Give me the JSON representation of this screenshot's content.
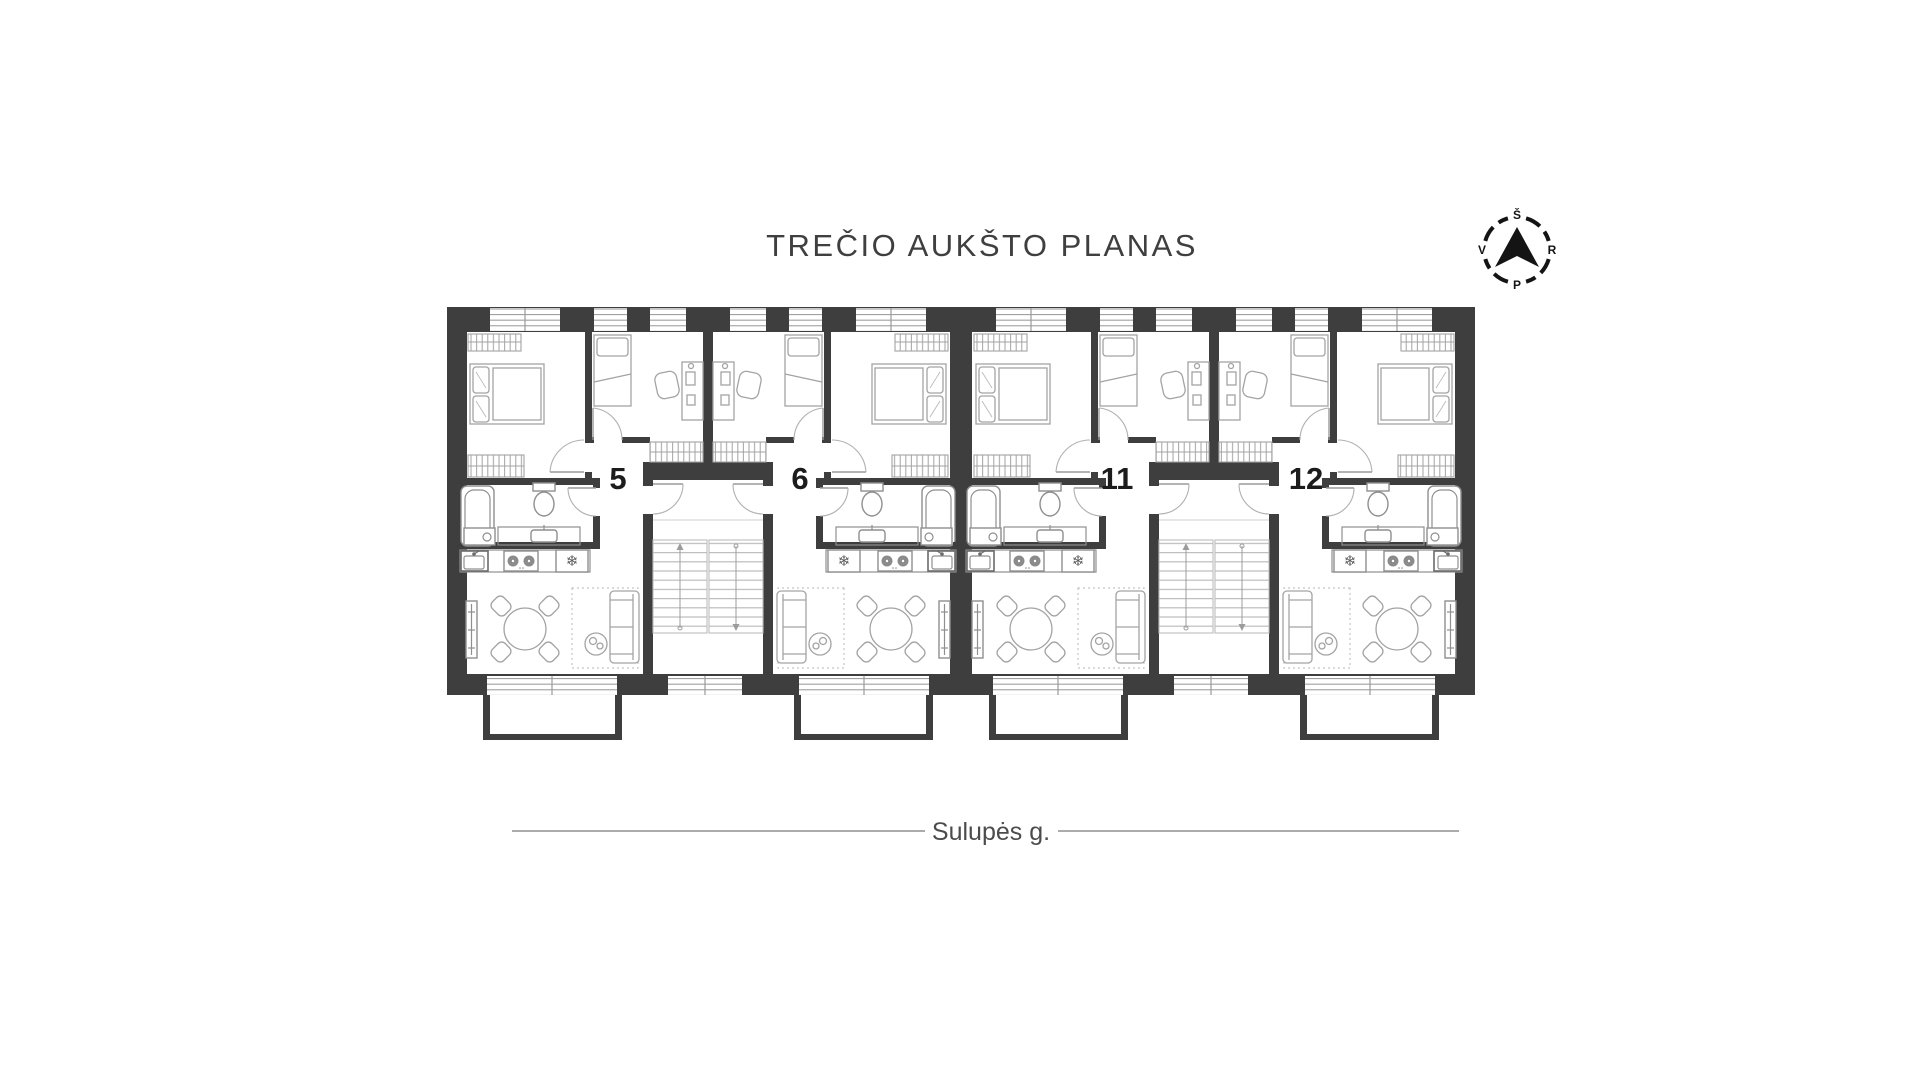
{
  "page": {
    "title_text": "TREČIO AUKŠTO PLANAS",
    "street_label": "Sulupės g."
  },
  "compass": {
    "north": "Š",
    "east": "R",
    "south": "P",
    "west": "V"
  },
  "apartments": [
    {
      "number": "5"
    },
    {
      "number": "6"
    },
    {
      "number": "11"
    },
    {
      "number": "12"
    }
  ],
  "icons": {
    "snowflake-icon": "❄"
  },
  "colors": {
    "wall": "#3e3e3e",
    "title": "#3f3f3f",
    "text_dark": "#1c1c1c",
    "furniture_line": "#a3a3a3",
    "fixture_line": "#8f8f8f",
    "street_line": "#8f8f8f",
    "street_text": "#4c4c4c",
    "glazing_line": "#9a9a9a",
    "tread_line": "#bdbdbd"
  }
}
